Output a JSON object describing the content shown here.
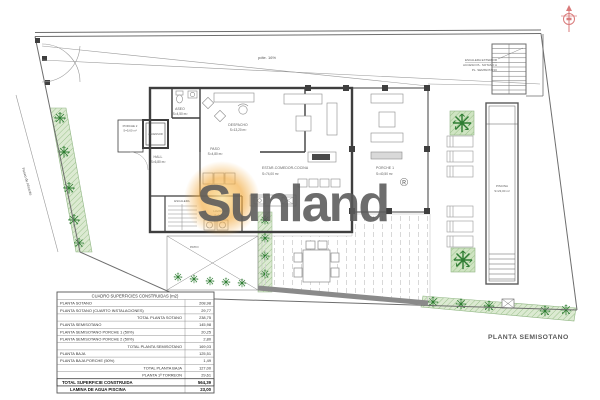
{
  "plan_title": "PLANTA SEMISOTANO",
  "watermark": {
    "brand": "Sunland",
    "registered_mark": "®"
  },
  "site": {
    "street_label": "Paseo de Alicante",
    "ramp_slope_label": "pdte. 16%",
    "stairs_note1": "ESCALERA EXTERIOR",
    "stairs_note2": "ACCESO PL. SOTANO A",
    "stairs_note3": "PL. SEMISOTANO"
  },
  "rooms": {
    "aseo": {
      "name": "ASEO",
      "area": "S=4,50 m²"
    },
    "despacho": {
      "name": "DESPACHO",
      "area": "S=13,20 m²"
    },
    "hall": {
      "name": "HALL",
      "area": "S=6,80 m²"
    },
    "paso": {
      "name": "PASO",
      "area": "S=4,80 m²"
    },
    "ascensor": {
      "name": "ASCENSOR"
    },
    "porche2": {
      "name": "PORCHE 2",
      "area": "S=5,60 m²"
    },
    "escalera": {
      "name": "ESCALERA"
    },
    "lavadero": {
      "name": "LAVADERO",
      "area": "S=3,05 m²"
    },
    "estar": {
      "name": "ESTAR-COMEDOR-COCINA",
      "area": "S=74,00 m²"
    },
    "porche1": {
      "name": "PORCHE 1",
      "area": "S=40,50 m²"
    },
    "patio": {
      "name": "PATIO"
    },
    "piscina": {
      "name": "PISCINA",
      "area": "S=23,00 m²"
    }
  },
  "areas_table": {
    "header": "CUADRO SUPERFICIES CONSTRUIDAS (m2)",
    "rows": [
      {
        "label": "PLANTA SOTANO",
        "value": "208,98"
      },
      {
        "label": "PLANTA SOTANO (CUARTO INSTALACIONES)",
        "value": "29,77"
      },
      {
        "label": "TOTAL PLANTA SOTANO",
        "value": "238,75"
      },
      {
        "label": "PLANTA SEMISOTANO",
        "value": "145,98"
      },
      {
        "label": "PLANTA SEMISOTANO PORCHE 1 (50%)",
        "value": "20,25"
      },
      {
        "label": "PLANTA SEMISOTANO PORCHE 2 (50%)",
        "value": "2,80"
      },
      {
        "label": "TOTAL PLANTA SEMISOTANO",
        "value": "169,03"
      },
      {
        "label": "PLANTA BAJA",
        "value": "125,51"
      },
      {
        "label": "PLANTA BAJA PORCHE (50%)",
        "value": "1,49"
      },
      {
        "label": "TOTAL PLANTA BAJA",
        "value": "127,00"
      },
      {
        "label": "PLANTA 1ª TORREON",
        "value": "29,61"
      },
      {
        "label": "TOTAL SUPERFICIE CONSTRUIDA",
        "value": "564,39"
      },
      {
        "label": "LAMINA DE AGUA PISCINA",
        "value": "23,00"
      }
    ]
  },
  "colors": {
    "watermark_blue": "#a8cfe4",
    "sun_orange": "#f2a93b",
    "garden_green": "#d9ead0",
    "north_red": "#d97b7b",
    "wall_dark": "#3f3f3f"
  }
}
